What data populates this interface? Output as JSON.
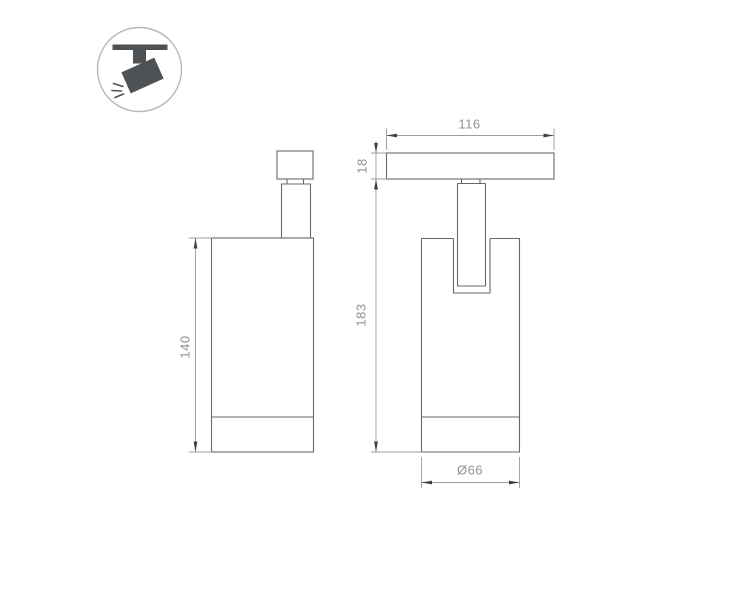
{
  "drawing": {
    "type": "technical-dimension-drawing",
    "subject": "magnetic-track-spot-light",
    "views": {
      "side_view": "side elevation of cylindrical spot body with track adapter",
      "front_view": "front elevation with track plate, yoke stem and body"
    },
    "labels": {
      "body_height": "140",
      "track_plate_width": "116",
      "track_plate_height": "18",
      "total_height": "183",
      "body_diameter": "Ø66"
    },
    "icon": {
      "name": "track-light-pictogram",
      "description": "tilted spotlight hanging from ceiling track with light rays"
    },
    "colors": {
      "object_line": "#66696b",
      "dimension_line": "#9a9da0",
      "arrow": "#3f4244",
      "label_text": "#8e9194",
      "icon_fill": "#4e5254",
      "icon_circle_stroke": "#b5b8ba",
      "background": "#ffffff"
    }
  }
}
